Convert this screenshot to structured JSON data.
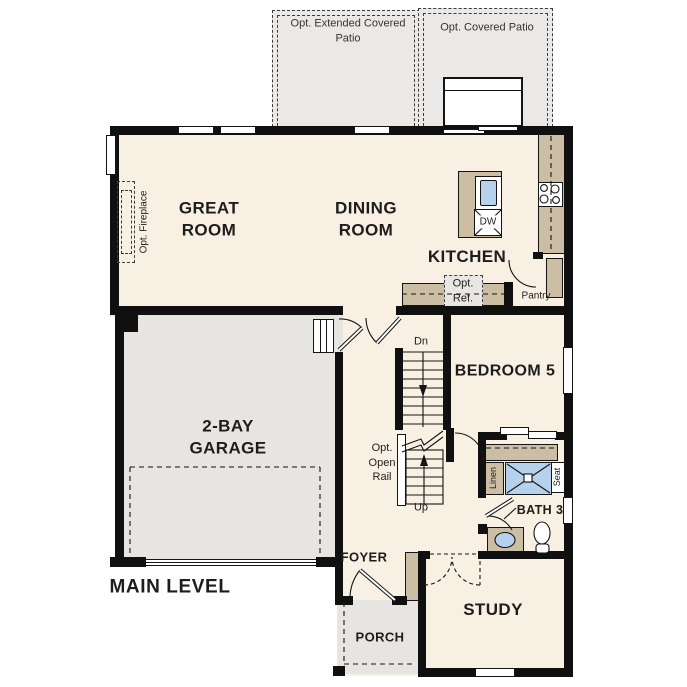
{
  "plan": {
    "title": "MAIN LEVEL",
    "colors": {
      "wall": "#101010",
      "interior": "#f8f0e3",
      "garage": "#e6e5e2",
      "patio": "#eae9e7",
      "cabinet": "#ccbea4",
      "fixture_blue": "#b5d1ec"
    },
    "patios": {
      "extended": "Opt. Extended Covered\nPatio",
      "covered": "Opt. Covered Patio"
    },
    "rooms": {
      "great_room": "GREAT\nROOM",
      "dining_room": "DINING\nROOM",
      "kitchen": "KITCHEN",
      "garage": "2-BAY\nGARAGE",
      "bedroom5": "BEDROOM 5",
      "bath3": "BATH 3",
      "foyer": "FOYER",
      "porch": "PORCH",
      "study": "STUDY"
    },
    "annotations": {
      "opt_fireplace": "Opt. Fireplace",
      "opt_ref": "Opt.\nRef.",
      "pantry": "Pantry",
      "dn": "Dn",
      "up": "Up",
      "opt_open_rail": "Opt.\nOpen\nRail",
      "linen": "Linen",
      "seat": "Seat",
      "dw": "DW"
    }
  }
}
